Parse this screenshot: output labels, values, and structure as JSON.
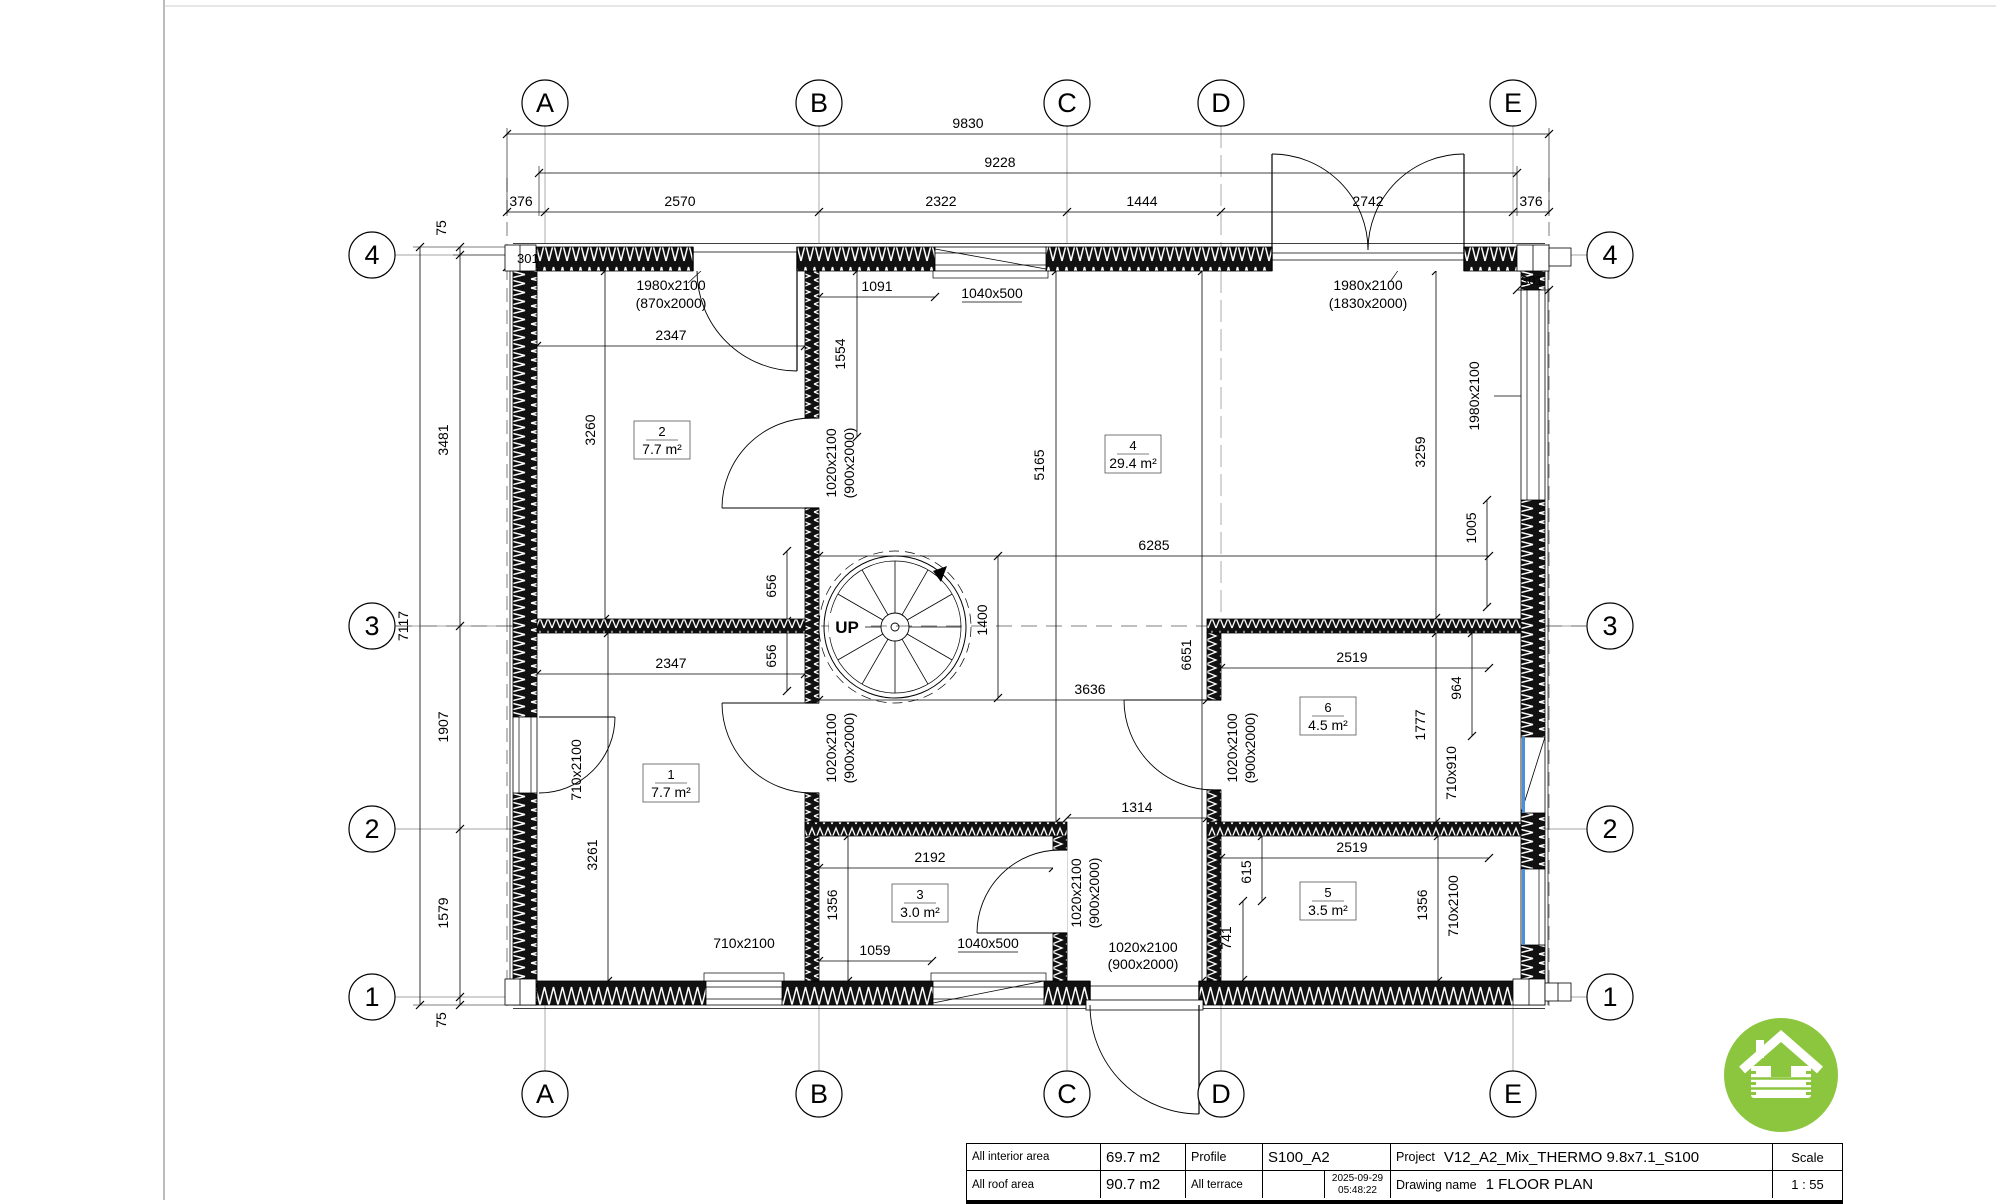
{
  "grid": {
    "cols": [
      "A",
      "B",
      "C",
      "D",
      "E"
    ],
    "rows": [
      "4",
      "3",
      "2",
      "1"
    ]
  },
  "dims": {
    "d9830": "9830",
    "d9228": "9228",
    "d376": "376",
    "d2570": "2570",
    "d2322": "2322",
    "d1444": "1444",
    "d2742": "2742",
    "d75": "75",
    "d3481": "3481",
    "d1907": "1907",
    "d1579": "1579",
    "d7117": "7117",
    "d301": "301",
    "d2347": "2347",
    "d3260": "3260",
    "d1091": "1091",
    "d1554": "1554",
    "d656": "656",
    "d1400": "1400",
    "d5165": "5165",
    "d6285": "6285",
    "d3259": "3259",
    "d6651": "6651",
    "d3636": "3636",
    "d3261": "3261",
    "d2192": "2192",
    "d1356": "1356",
    "d1059": "1059",
    "d1314": "1314",
    "d615": "615",
    "d741": "741",
    "d2519": "2519",
    "d964": "964",
    "d1777": "1777",
    "d1005": "1005"
  },
  "openings": {
    "entry_door": {
      "line1": "1980x2100",
      "line2": "(870x2000)"
    },
    "double_door": {
      "line1": "1980x2100",
      "line2": "(1830x2000)"
    },
    "interior_door": {
      "line1": "1020x2100",
      "line2": "(900x2000)"
    },
    "window_small": "1040x500",
    "window_large": "1980x2100",
    "window_710": "710x2100",
    "window_710x910": "710x910"
  },
  "rooms": [
    {
      "number": "1",
      "area": "7.7 m²"
    },
    {
      "number": "2",
      "area": "7.7 m²"
    },
    {
      "number": "3",
      "area": "3.0 m²"
    },
    {
      "number": "4",
      "area": "29.4 m²"
    },
    {
      "number": "5",
      "area": "3.5 m²"
    },
    {
      "number": "6",
      "area": "4.5 m²"
    }
  ],
  "stair": {
    "up": "UP"
  },
  "title_block": {
    "interior_area_label": "All interior area",
    "interior_area_value": "69.7 m2",
    "roof_area_label": "All roof area",
    "roof_area_value": "90.7 m2",
    "profile_label": "Profile",
    "profile_value": "S100_A2",
    "terrace_label": "All terrace",
    "terrace_value": "",
    "date": "2025-09-29",
    "time": "05:48:22",
    "project_label": "Project",
    "project_value": "V12_A2_Mix_THERMO 9.8x7.1_S100",
    "drawing_label": "Drawing name",
    "drawing_value": "1 FLOOR PLAN",
    "scale_label": "Scale",
    "scale_value": "1 : 55"
  },
  "colors": {
    "logo_green": "#8cc63f",
    "window_blue": "#4a90d9",
    "line_black": "#000000"
  }
}
